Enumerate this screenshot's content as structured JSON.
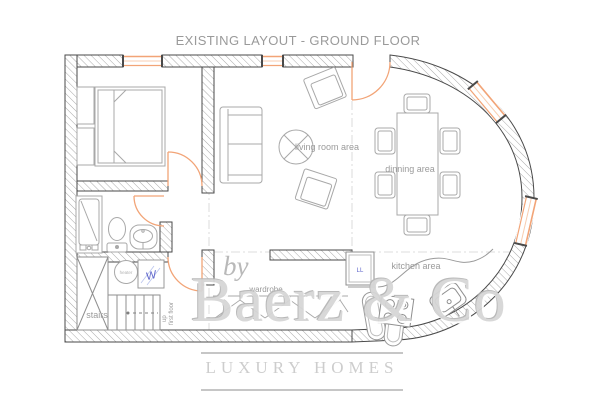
{
  "title": "EXISTING LAYOUT -  GROUND FLOOR",
  "labels": {
    "living_room": "living room area",
    "dining": "dinning area",
    "kitchen": "kitchen area",
    "wardrobe": "wardrobe",
    "stairs": "stairs",
    "up": "up",
    "first_floor": "first floor"
  },
  "appliances": {
    "heater": "heater",
    "washer": "W",
    "fridge": "LL"
  },
  "watermark": {
    "by": "by",
    "brand": "Baerz & Co",
    "tagline": "LUXURY HOMES"
  },
  "colors": {
    "opening_orange": "#f2a477",
    "wall_line": "#4a4a4a",
    "hatch_gray": "#a0a0a0",
    "furniture_gray": "#a8a8a8",
    "label_gray": "#9b9b9b",
    "appliance_blue": "#5b62c9",
    "watermark_gray": "#d6d6d6"
  }
}
